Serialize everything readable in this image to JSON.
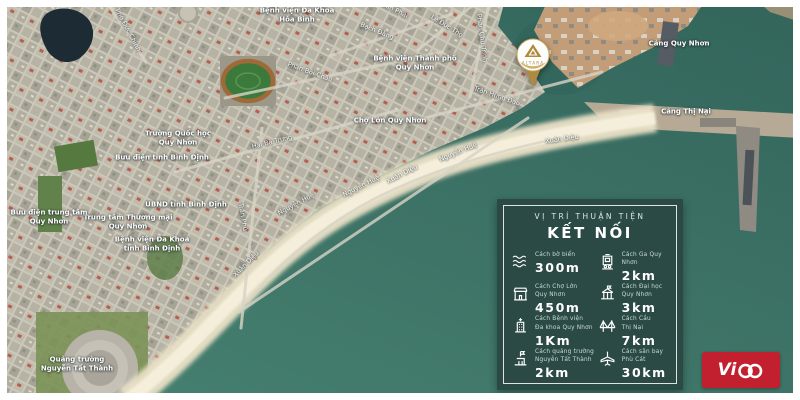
{
  "pin": {
    "brand": "ALTARA"
  },
  "panel": {
    "subtitle": "VỊ TRÍ THUẬN TIỆN",
    "title": "KẾT NỐI",
    "items": [
      {
        "icon": "waves-icon",
        "label_lines": [
          "Cách bờ biển"
        ],
        "value": "300m"
      },
      {
        "icon": "market-icon",
        "label_lines": [
          "Cách Chợ Lớn",
          "Quy Nhơn"
        ],
        "value": "450m"
      },
      {
        "icon": "hospital-icon",
        "label_lines": [
          "Cách Bệnh viện",
          "Đa khoa Quy Nhơn"
        ],
        "value": "1Km"
      },
      {
        "icon": "plaza-icon",
        "label_lines": [
          "Cách quảng trường",
          "Nguyễn Tất Thành"
        ],
        "value": "2km"
      },
      {
        "icon": "train-icon",
        "label_lines": [
          "Cách Ga Quy Nhơn"
        ],
        "value": "2km"
      },
      {
        "icon": "university-icon",
        "label_lines": [
          "Cách Đại học",
          "Quy Nhơn"
        ],
        "value": "3km"
      },
      {
        "icon": "bridge-icon",
        "label_lines": [
          "Cách Cầu",
          "Thị Nại"
        ],
        "value": "7km"
      },
      {
        "icon": "plane-icon",
        "label_lines": [
          "Cách sân bay",
          "Phù Cát"
        ],
        "value": "30km"
      }
    ]
  },
  "logo": {
    "vi": "Vi"
  },
  "map": {
    "labels": [
      {
        "kind": "place",
        "lines": [
          "Bệnh viện Đa Khoa",
          "Hòa Bình"
        ],
        "x": 297,
        "y": 15,
        "rot": 0
      },
      {
        "kind": "place",
        "lines": [
          "Bệnh viện Thành phố",
          "Quy Nhơn"
        ],
        "x": 415,
        "y": 63,
        "rot": 0
      },
      {
        "kind": "place",
        "lines": [
          "Chợ Lớn Quy Nhơn"
        ],
        "x": 390,
        "y": 121,
        "rot": 0
      },
      {
        "kind": "place",
        "lines": [
          "Trường Quốc học",
          "Quy Nhơn"
        ],
        "x": 178,
        "y": 138,
        "rot": 0
      },
      {
        "kind": "place",
        "lines": [
          "Bưu điện tỉnh Bình Định"
        ],
        "x": 162,
        "y": 158,
        "rot": 0
      },
      {
        "kind": "place",
        "lines": [
          "UBND tỉnh Bình Định"
        ],
        "x": 186,
        "y": 205,
        "rot": 0
      },
      {
        "kind": "place",
        "lines": [
          "Trung tâm Thương mại",
          "Quy Nhơn"
        ],
        "x": 128,
        "y": 222,
        "rot": 0
      },
      {
        "kind": "place",
        "lines": [
          "Bưu điện trung tâm",
          "Quy Nhơn"
        ],
        "x": 49,
        "y": 217,
        "rot": 0
      },
      {
        "kind": "place",
        "lines": [
          "Bệnh viện Đa Khoa",
          "tỉnh Bình Định"
        ],
        "x": 152,
        "y": 244,
        "rot": 0
      },
      {
        "kind": "place",
        "lines": [
          "Quảng trường",
          "Nguyễn Tất Thành"
        ],
        "x": 77,
        "y": 364,
        "rot": 0
      },
      {
        "kind": "place",
        "lines": [
          "Cảng Quy Nhơn"
        ],
        "x": 679,
        "y": 44,
        "rot": 0
      },
      {
        "kind": "place",
        "lines": [
          "Cảng Thị Nại"
        ],
        "x": 686,
        "y": 112,
        "rot": 0
      },
      {
        "kind": "street",
        "lines": [
          "Phó Đức Chính"
        ],
        "x": 128,
        "y": 30,
        "rot": 62
      },
      {
        "kind": "street",
        "lines": [
          "Xuân Phái"
        ],
        "x": 393,
        "y": 9,
        "rot": 26
      },
      {
        "kind": "street",
        "lines": [
          "Bạch Đằng"
        ],
        "x": 377,
        "y": 31,
        "rot": 22
      },
      {
        "kind": "street",
        "lines": [
          "Lê Đức Thọ"
        ],
        "x": 447,
        "y": 26,
        "rot": 32
      },
      {
        "kind": "street",
        "lines": [
          "Phan Chu Trinh"
        ],
        "x": 482,
        "y": 38,
        "rot": 82
      },
      {
        "kind": "street",
        "lines": [
          "Phan Bội Châu"
        ],
        "x": 310,
        "y": 72,
        "rot": 20
      },
      {
        "kind": "street",
        "lines": [
          "Trần Hưng Đạo"
        ],
        "x": 497,
        "y": 96,
        "rot": 19
      },
      {
        "kind": "street",
        "lines": [
          "Hai Bà Trưng"
        ],
        "x": 272,
        "y": 142,
        "rot": -14
      },
      {
        "kind": "street",
        "lines": [
          "Trần Phú"
        ],
        "x": 243,
        "y": 217,
        "rot": 80
      },
      {
        "kind": "street",
        "lines": [
          "Nguyễn Huệ"
        ],
        "x": 296,
        "y": 204,
        "rot": -28
      },
      {
        "kind": "street",
        "lines": [
          "Nguyễn Huệ"
        ],
        "x": 361,
        "y": 186,
        "rot": -27
      },
      {
        "kind": "street",
        "lines": [
          "Xuân Diệu"
        ],
        "x": 402,
        "y": 174,
        "rot": -27
      },
      {
        "kind": "street",
        "lines": [
          "Nguyễn Huệ"
        ],
        "x": 458,
        "y": 152,
        "rot": -22
      },
      {
        "kind": "street",
        "lines": [
          "Xuân Diệu"
        ],
        "x": 562,
        "y": 139,
        "rot": -8
      },
      {
        "kind": "street",
        "lines": [
          "Xuân Diệu"
        ],
        "x": 246,
        "y": 264,
        "rot": -45
      }
    ]
  },
  "colors": {
    "sea": "#3d7266",
    "sand": "#ebe2c9",
    "city": "#b5b1a4",
    "panel_bg": "#2b4a45",
    "logo_red": "#c2202e",
    "pin_gold": "#b08a3e"
  }
}
